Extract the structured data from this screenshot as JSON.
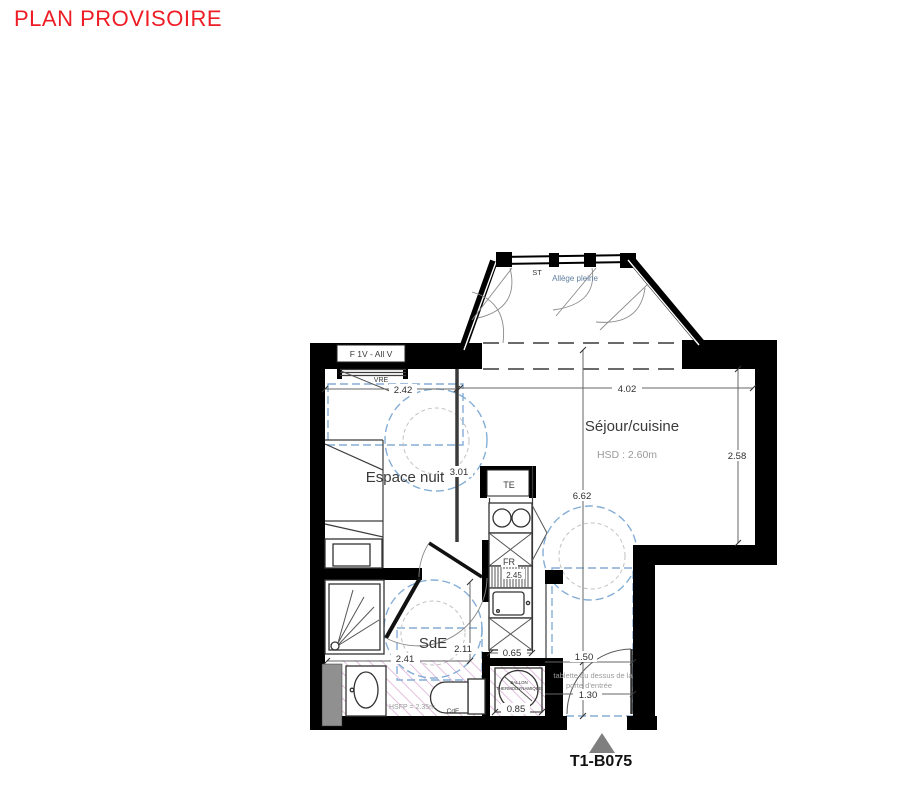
{
  "title": "PLAN PROVISOIRE",
  "plan": {
    "unit": "T1-B075",
    "rooms": {
      "sejour": {
        "name": "Séjour/cuisine",
        "ceiling_height": "HSD : 2.60m"
      },
      "espace_nuit": {
        "name": "Espace nuit"
      },
      "sde": {
        "name": "SdE"
      }
    },
    "labels": {
      "window_type": "F 1V - All V",
      "vre": "VRE",
      "st": "ST",
      "allege": "Allège pleine",
      "te": "TE",
      "fr": "FR",
      "ballon_line1": "BALLON",
      "ballon_line2": "THERMODYNAMIQUE",
      "tablette_line1": "tablette au dessus de la",
      "tablette_line2": "porte d'entrée",
      "dropped_ceiling": "HSFP = 2.35m",
      "cde": "CdE"
    },
    "dims": {
      "espace_nuit_width": "2.42",
      "sejour_width": "4.02",
      "espace_nuit_length": "3.01",
      "sejour_depth": "2.58",
      "total_length": "6.62",
      "kitchen_length": "2.45",
      "sde_width": "2.41",
      "sde_length": "2.11",
      "kitchen_width": "0.65",
      "entry_upper": "1.50",
      "entry_lower": "1.30",
      "ballon_width": "0.85"
    }
  },
  "colors": {
    "title_red": "#ee1c25",
    "wall_black": "#000000",
    "clearance_blue": "#85aed6",
    "hatch_pink": "#d49bce",
    "triangle_gray": "#7f7f7f"
  }
}
